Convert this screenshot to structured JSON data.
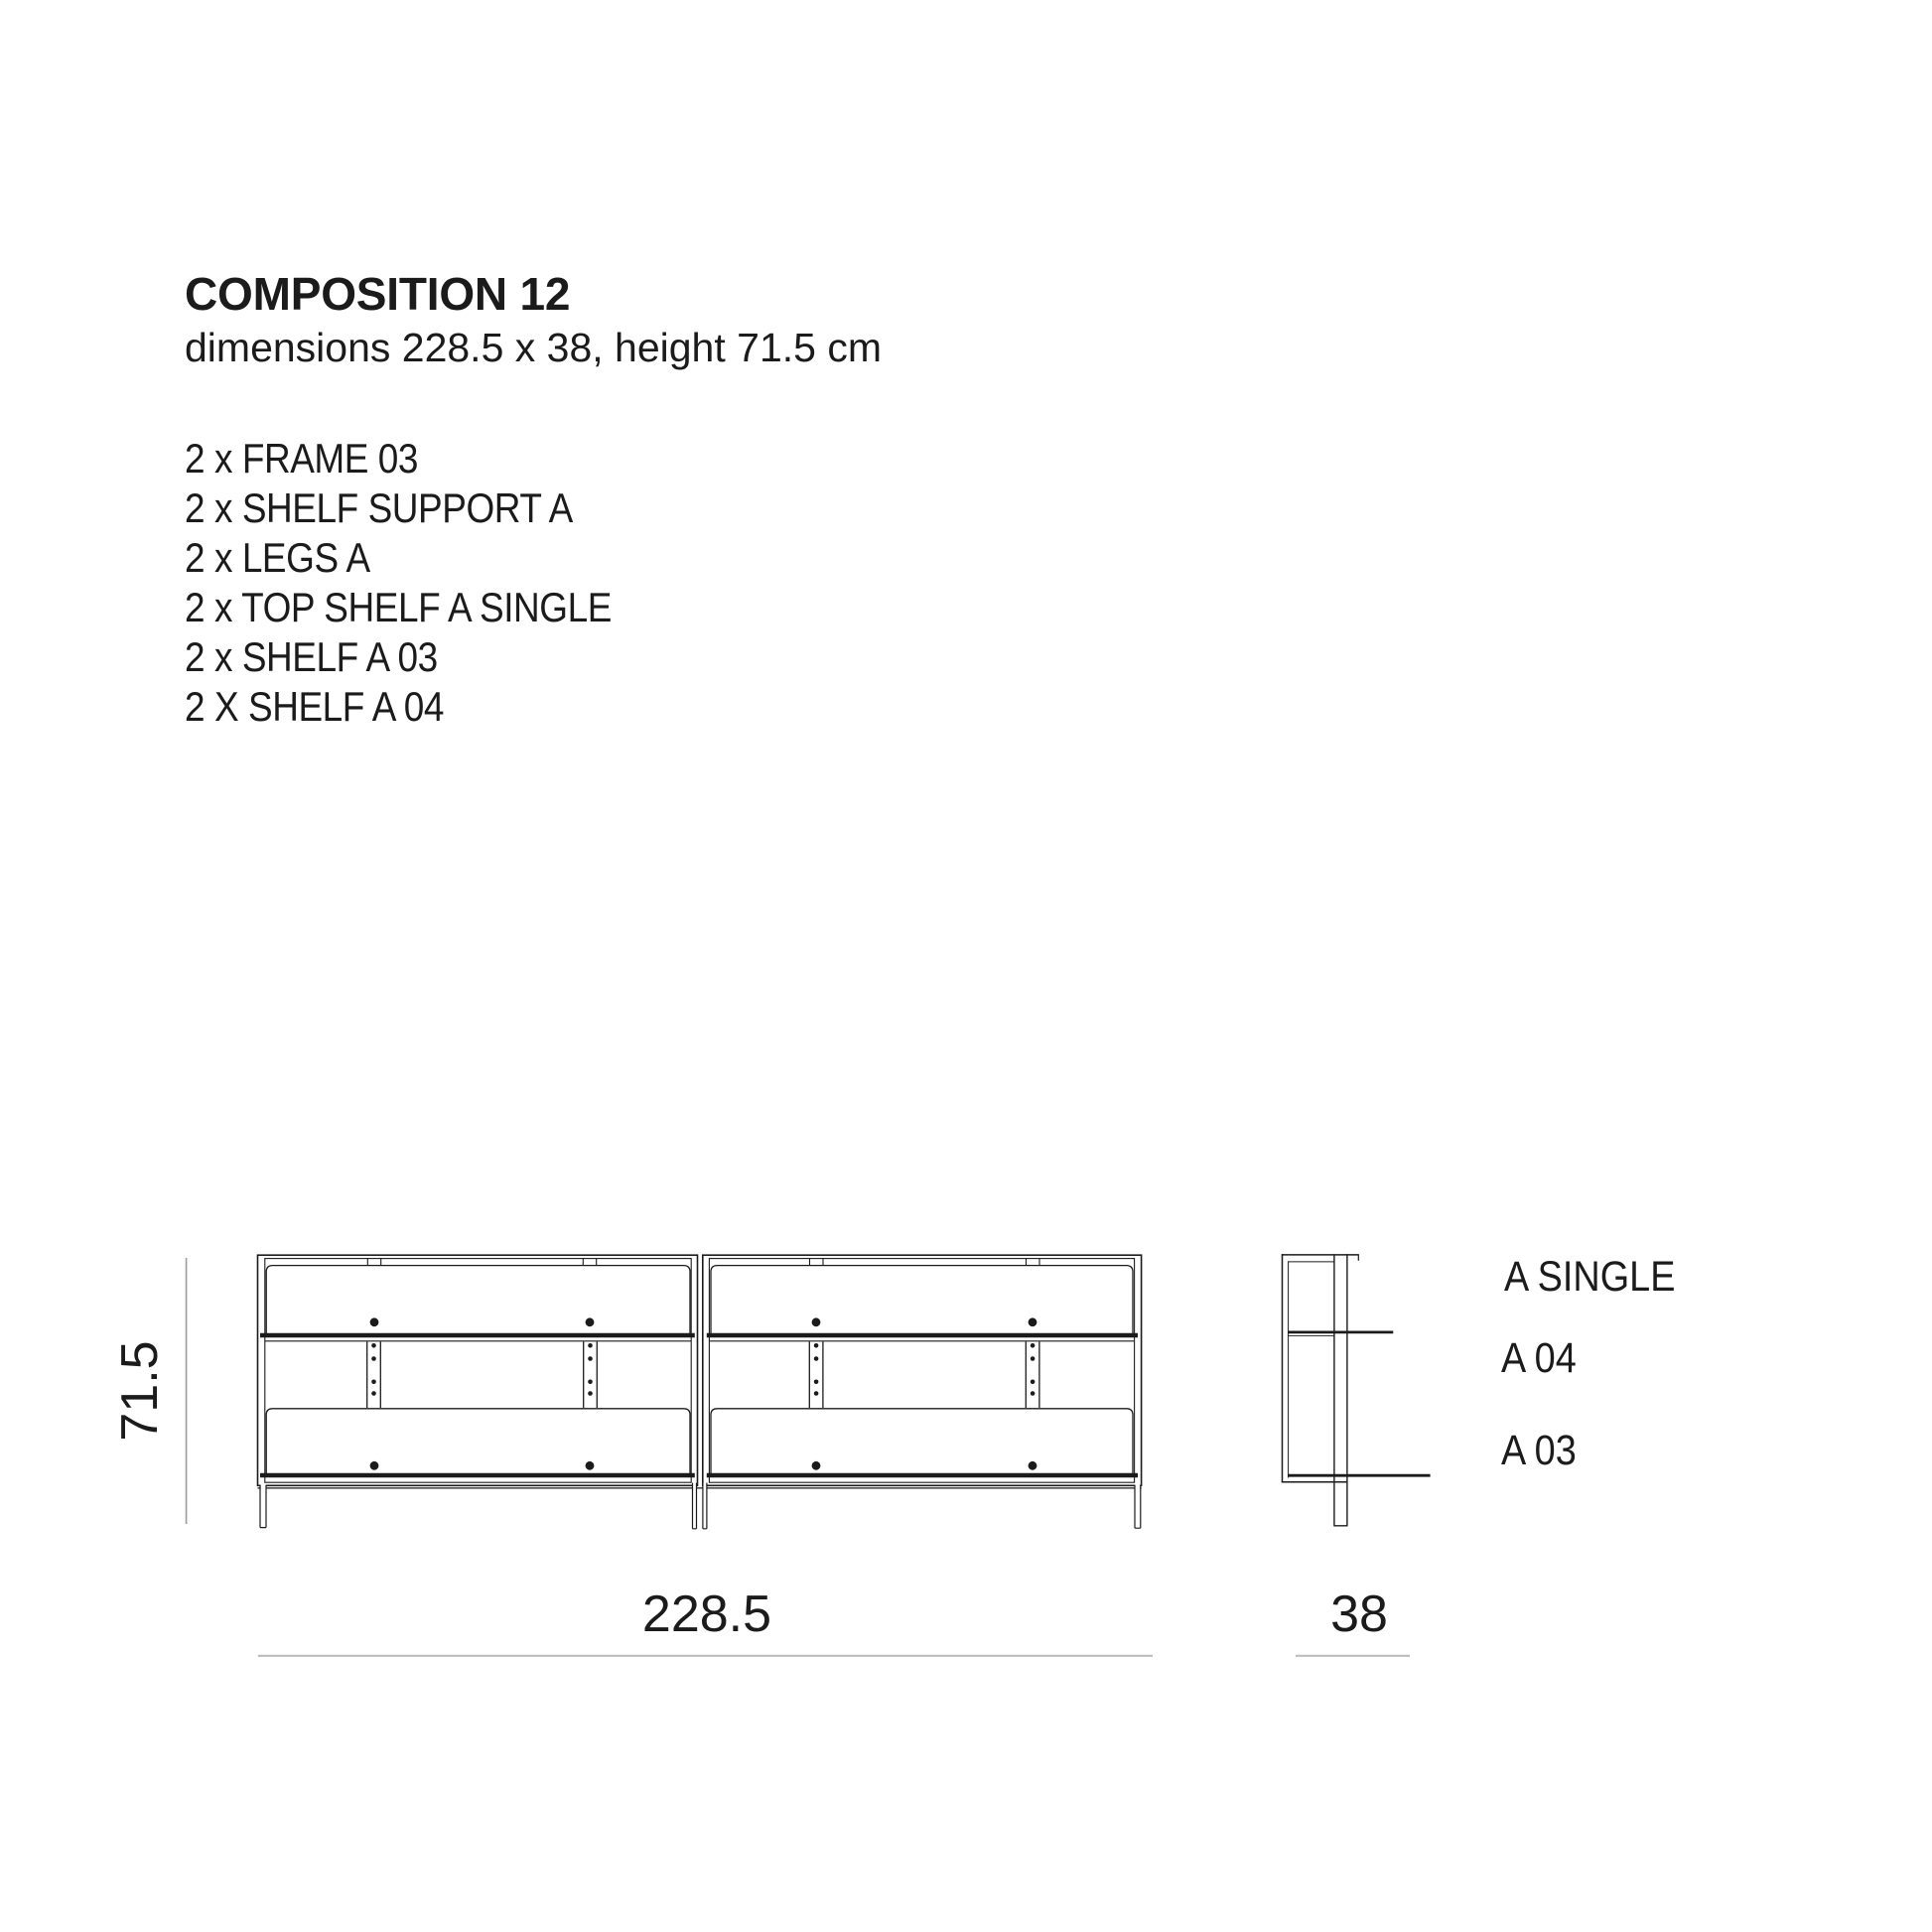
{
  "header": {
    "title": "COMPOSITION 12",
    "subtitle": "dimensions 228.5 x 38, height 71.5 cm"
  },
  "parts_list": {
    "items": [
      "2 x FRAME 03",
      "2 x SHELF SUPPORT A",
      "2 x LEGS A",
      "2 x TOP SHELF A SINGLE",
      "2 x SHELF A 03",
      "2 X SHELF A 04"
    ]
  },
  "dimensions": {
    "height": "71.5",
    "width": "228.5",
    "depth": "38"
  },
  "side_view_labels": {
    "top": "A SINGLE",
    "middle": "A 04",
    "bottom": "A 03"
  },
  "colors": {
    "ink": "#1b1b1b",
    "dimension_line": "#bcbcbc",
    "height_line": "#9c9c9c"
  }
}
